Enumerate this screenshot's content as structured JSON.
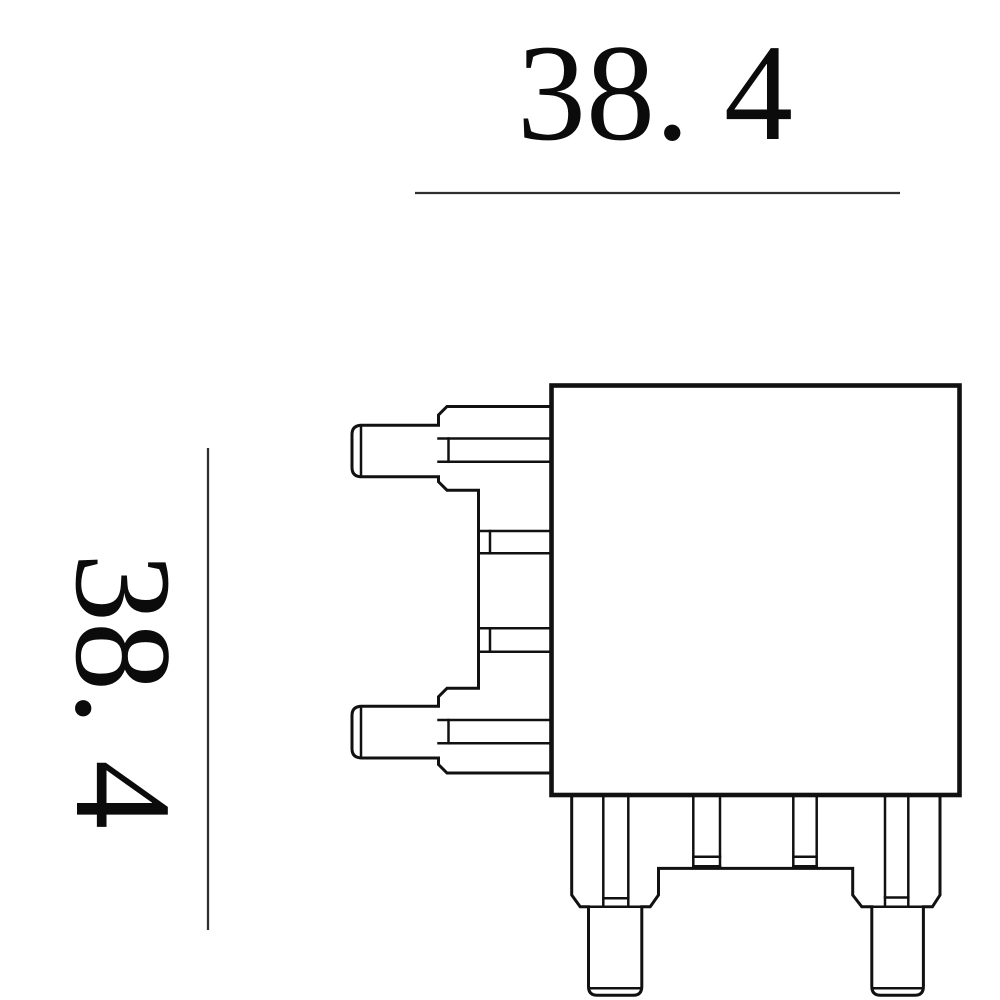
{
  "drawing": {
    "type": "technical-drawing-side-view",
    "dimensions": {
      "top": {
        "label": "38. 4",
        "value": 38.4,
        "orientation": "horizontal"
      },
      "left": {
        "label": "38. 4",
        "value": 38.4,
        "orientation": "vertical-rotated-90"
      }
    },
    "colors": {
      "line": "#111111",
      "dimension_line": "#2f2f2f",
      "text": "#0b0b0b",
      "background": "#ffffff"
    }
  }
}
